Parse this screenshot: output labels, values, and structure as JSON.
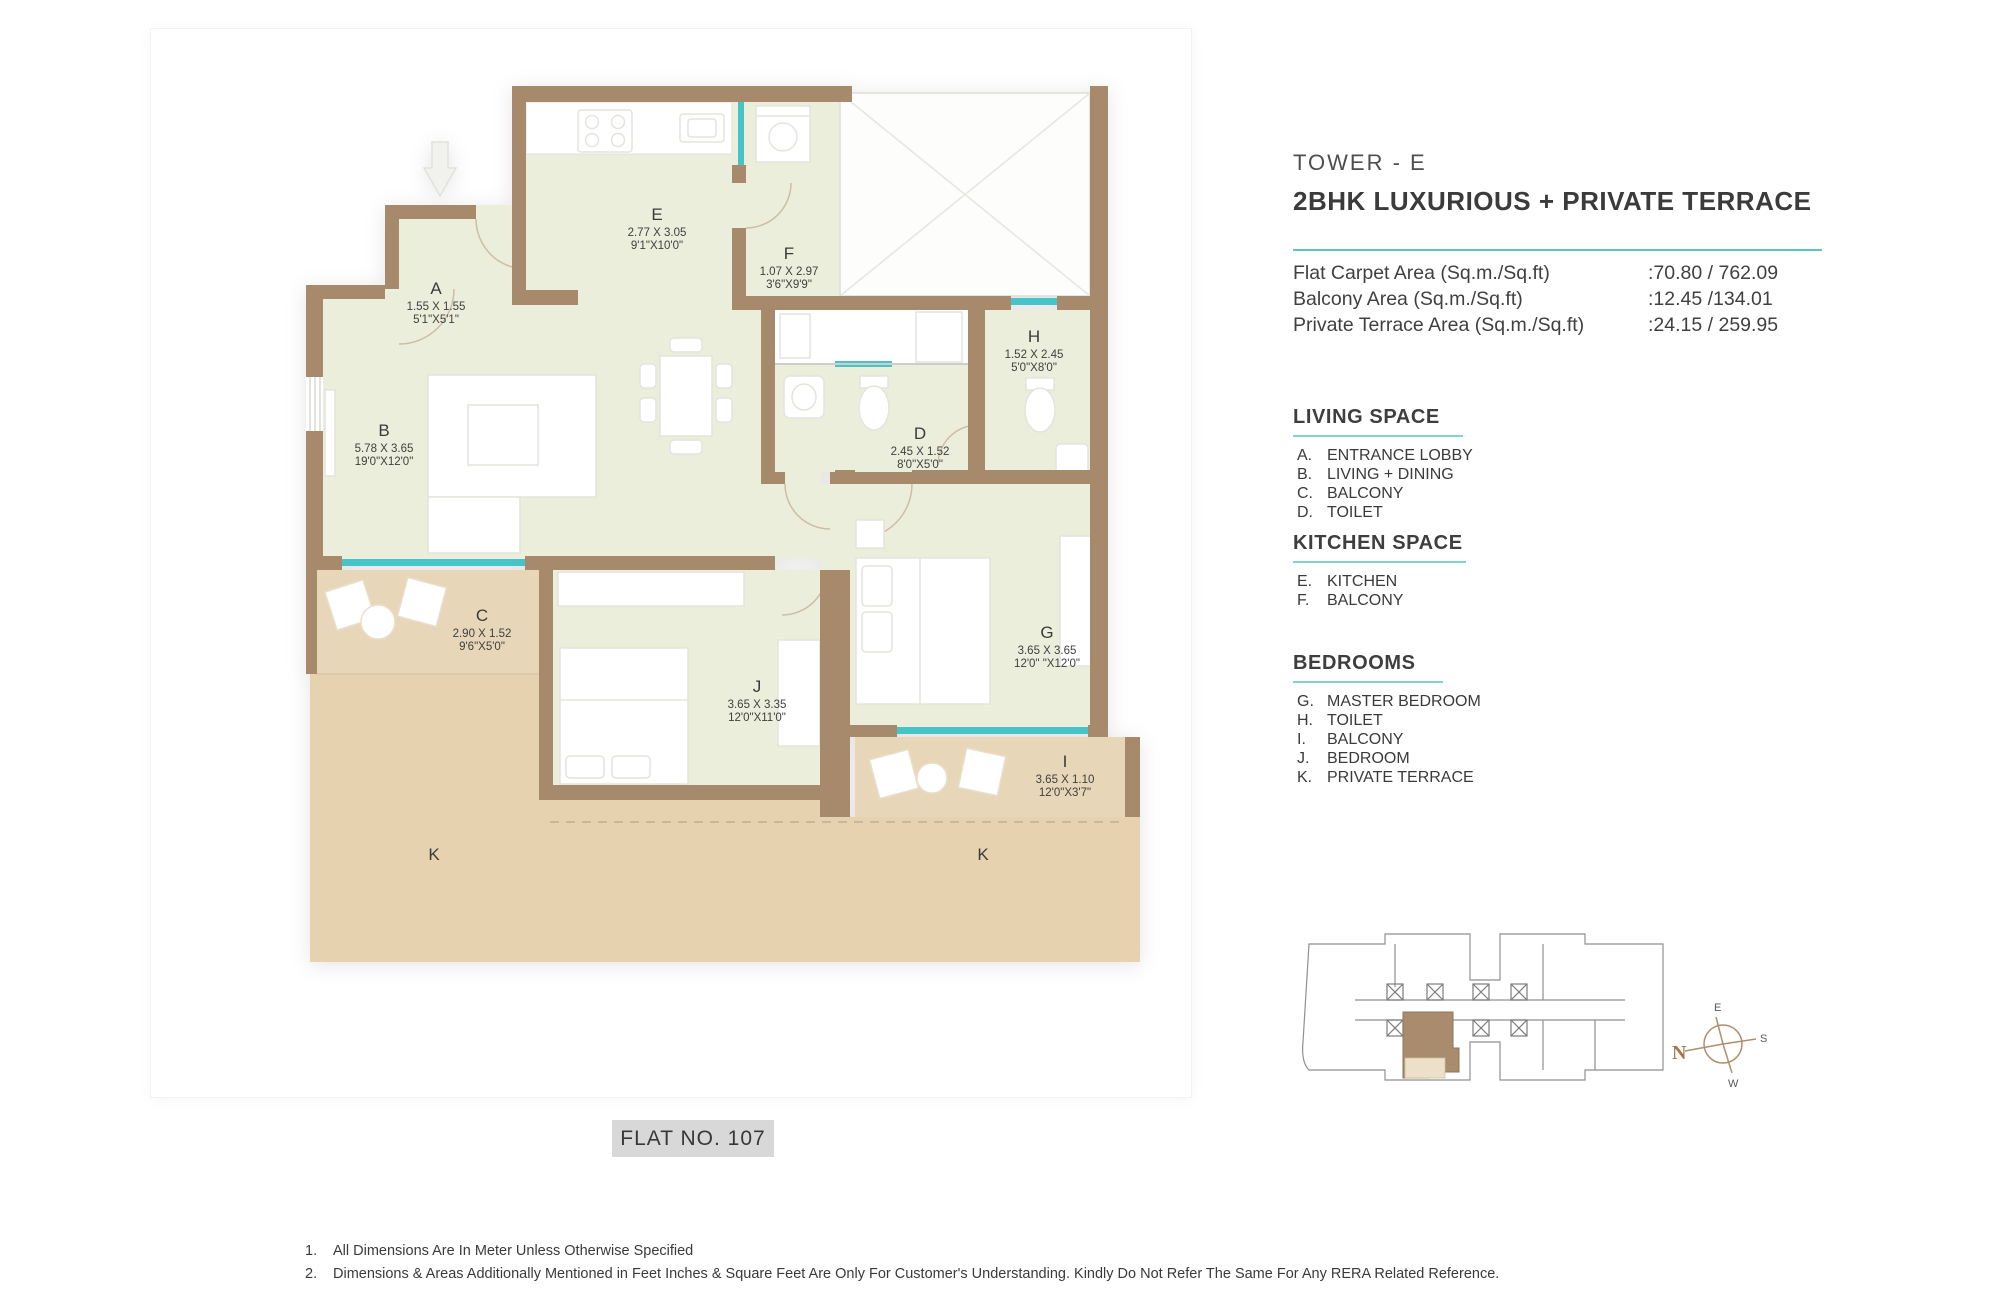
{
  "header": {
    "tower": "TOWER - E",
    "title": "2BHK LUXURIOUS + PRIVATE TERRACE",
    "areas": [
      {
        "label": "Flat Carpet Area (Sq.m./Sq.ft)",
        "value": ":70.80 / 762.09"
      },
      {
        "label": "Balcony Area (Sq.m./Sq.ft)",
        "value": ":12.45 /134.01"
      },
      {
        "label": "Private Terrace Area (Sq.m./Sq.ft)",
        "value": ":24.15 / 259.95"
      }
    ]
  },
  "legend": {
    "sections": [
      {
        "title": "LIVING SPACE",
        "items": [
          {
            "key": "A.",
            "label": "ENTRANCE LOBBY"
          },
          {
            "key": "B.",
            "label": "LIVING + DINING"
          },
          {
            "key": "C.",
            "label": "BALCONY"
          },
          {
            "key": "D.",
            "label": "TOILET"
          }
        ]
      },
      {
        "title": "KITCHEN SPACE",
        "items": [
          {
            "key": "E.",
            "label": "KITCHEN"
          },
          {
            "key": "F.",
            "label": "BALCONY"
          }
        ]
      },
      {
        "title": "BEDROOMS",
        "items": [
          {
            "key": "G.",
            "label": "MASTER BEDROOM"
          },
          {
            "key": "H.",
            "label": "TOILET"
          },
          {
            "key": "I.",
            "label": "BALCONY"
          },
          {
            "key": "J.",
            "label": "BEDROOM"
          },
          {
            "key": "K.",
            "label": "PRIVATE TERRACE"
          }
        ]
      }
    ]
  },
  "plan": {
    "flat_label": "FLAT NO. 107",
    "terrace_left": "K",
    "terrace_right": "K",
    "rooms": [
      {
        "letter": "A",
        "m": "1.55 X 1.55",
        "ft": "5'1\"X5'1\""
      },
      {
        "letter": "B",
        "m": "5.78 X 3.65",
        "ft": "19'0\"X12'0\""
      },
      {
        "letter": "C",
        "m": "2.90 X 1.52",
        "ft": "9'6\"X5'0\""
      },
      {
        "letter": "D",
        "m": "2.45 X 1.52",
        "ft": "8'0\"X5'0\""
      },
      {
        "letter": "E",
        "m": "2.77 X 3.05",
        "ft": "9'1\"X10'0\""
      },
      {
        "letter": "F",
        "m": "1.07 X 2.97",
        "ft": "3'6\"X9'9\""
      },
      {
        "letter": "G",
        "m": "3.65 X 3.65",
        "ft": "12'0\" \"X12'0\""
      },
      {
        "letter": "H",
        "m": "1.52 X 2.45",
        "ft": "5'0\"X8'0\""
      },
      {
        "letter": "I",
        "m": "3.65 X 1.10",
        "ft": "12'0\"X3'7\""
      },
      {
        "letter": "J",
        "m": "3.65 X 3.35",
        "ft": "12'0\"X11'0\""
      }
    ]
  },
  "compass": {
    "n": "N",
    "e": "E",
    "s": "S",
    "w": "W"
  },
  "notes": [
    {
      "num": "1.",
      "text": "All Dimensions Are In Meter Unless Otherwise Specified"
    },
    {
      "num": "2.",
      "text": "Dimensions & Areas Additionally Mentioned in Feet Inches & Square Feet Are Only For Customer's Understanding. Kindly Do Not Refer The Same For Any RERA Related Reference."
    }
  ],
  "colors": {
    "accent_teal": "#57c7bf",
    "wall_brown": "#a7896c",
    "room_fill": "#ebeedb",
    "terrace_fill": "#e8d6b8",
    "window_teal": "#47c4c7",
    "unit_highlight": "#a98c6e"
  }
}
